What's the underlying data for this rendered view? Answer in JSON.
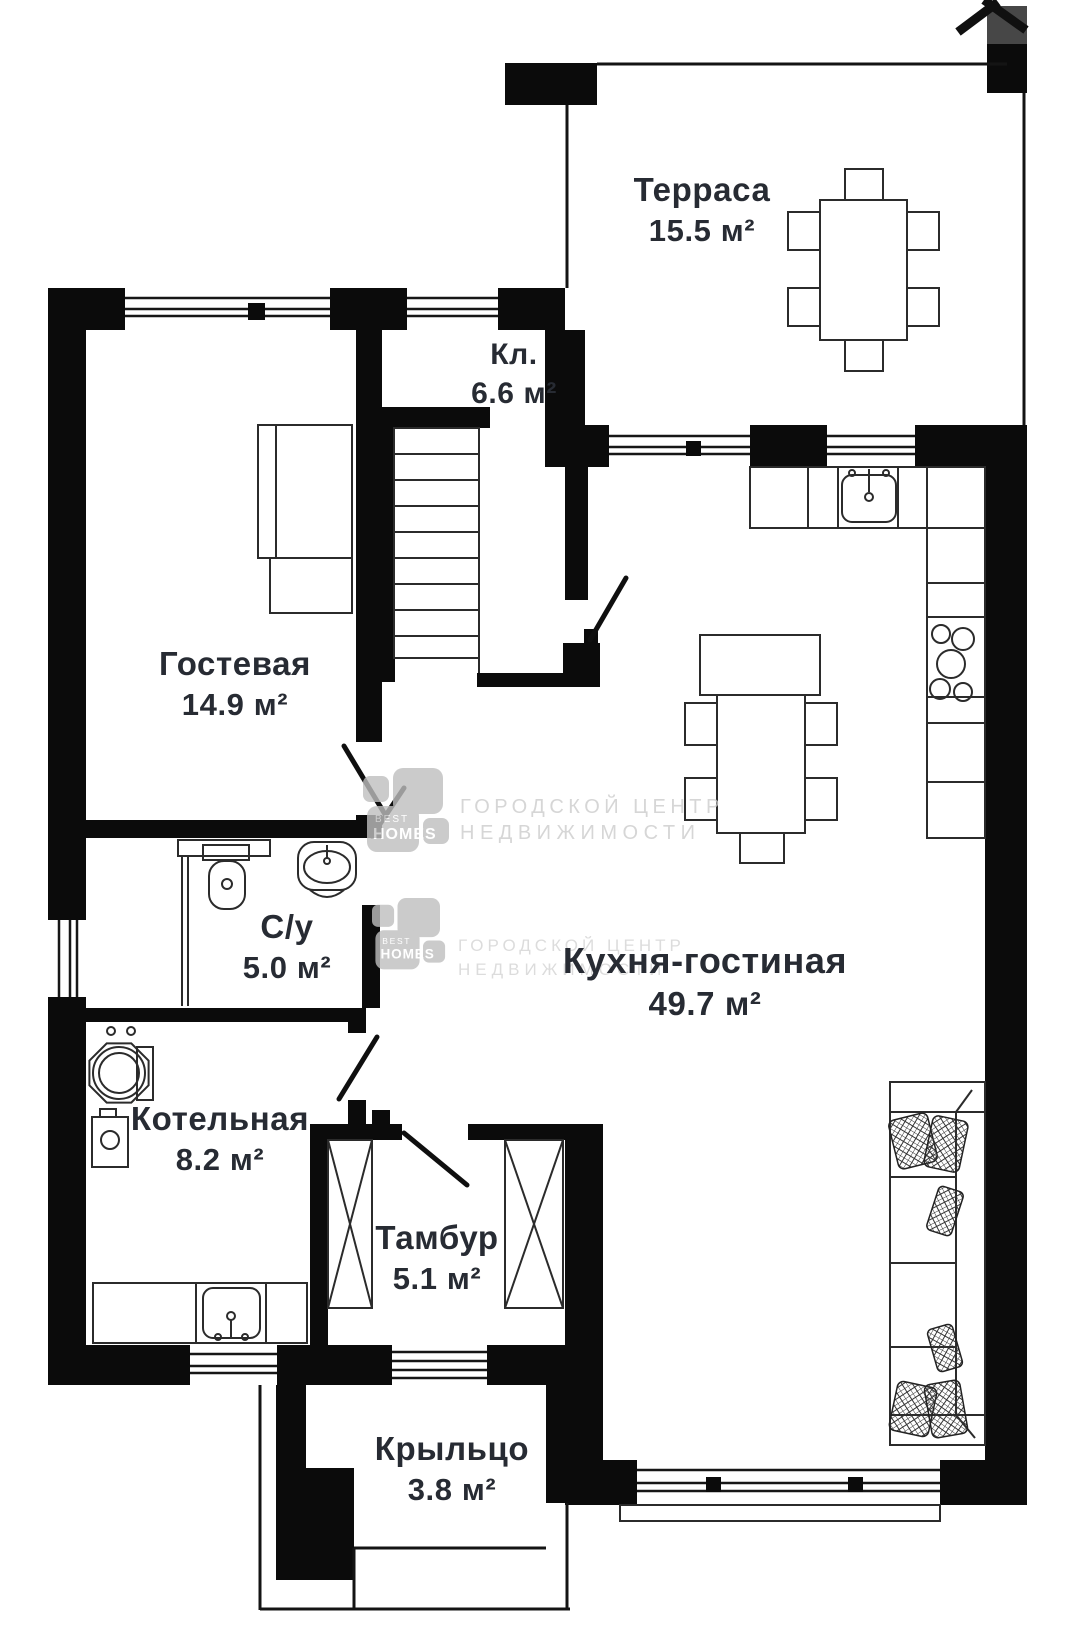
{
  "plan": {
    "colors": {
      "wall": "#0b0b0b",
      "furniture_line": "#2b2b2b",
      "label_text": "#272b33",
      "watermark": "#cccccc"
    },
    "corner_mark_icon": "x-cross",
    "rooms": [
      {
        "id": "terrace",
        "name": "Терраса",
        "area": "15.5 м²"
      },
      {
        "id": "closet",
        "name": "Кл.",
        "area": "6.6 м²"
      },
      {
        "id": "guest",
        "name": "Гостевая",
        "area": "14.9 м²"
      },
      {
        "id": "bathroom",
        "name": "С/у",
        "area": "5.0 м²"
      },
      {
        "id": "kitchen",
        "name": "Кухня-гостиная",
        "area": "49.7 м²"
      },
      {
        "id": "boiler",
        "name": "Котельная",
        "area": "8.2 м²"
      },
      {
        "id": "vestibule",
        "name": "Тамбур",
        "area": "5.1 м²"
      },
      {
        "id": "porch",
        "name": "Крыльцо",
        "area": "3.8 м²"
      }
    ],
    "watermark": {
      "line1": "ГОРОДСКОЙ ЦЕНТР",
      "line2": "НЕДВИЖИМОСТИ",
      "brand_top": "BEST",
      "brand_bottom": "HOMES"
    }
  }
}
